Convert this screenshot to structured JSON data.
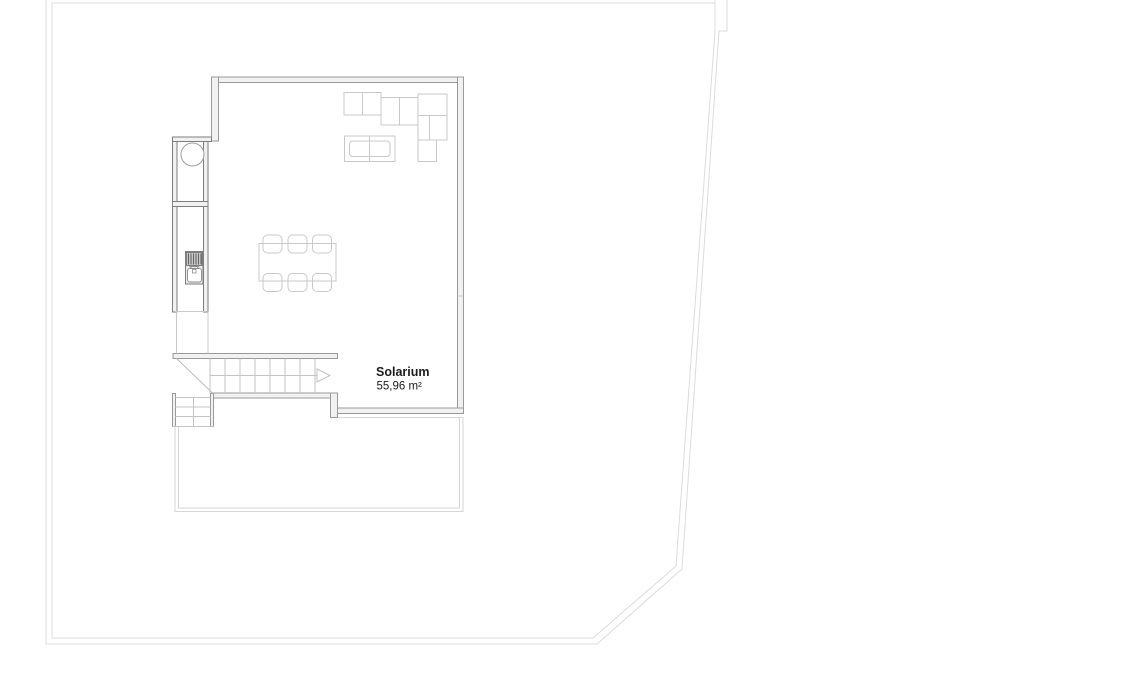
{
  "page": {
    "background_color": "#ffffff",
    "drawing_type": "architectural roof floor plan"
  },
  "plan": {
    "room_label": {
      "name": "Solarium",
      "area": "55,96 m²"
    },
    "features": [
      "property-boundary",
      "solarium-room",
      "sectional-sofa",
      "coffee-table",
      "dining-table-with-6-chairs",
      "outdoor-kitchen-unit",
      "washbasin",
      "sink",
      "staircase-with-direction-arrow",
      "lower-steps",
      "roof-terrace"
    ],
    "colors": {
      "boundary": "#dcdcdc",
      "wall_stroke": "#9a9a9a",
      "wall_fill": "#f1f1f1",
      "fixture_stroke": "#7e7e7e",
      "furniture_stroke": "#c9c9c9",
      "stair_stroke": "#c3c3c3",
      "terrace_stroke": "#d6d6d6",
      "label_text": "#1c1c1c"
    }
  }
}
